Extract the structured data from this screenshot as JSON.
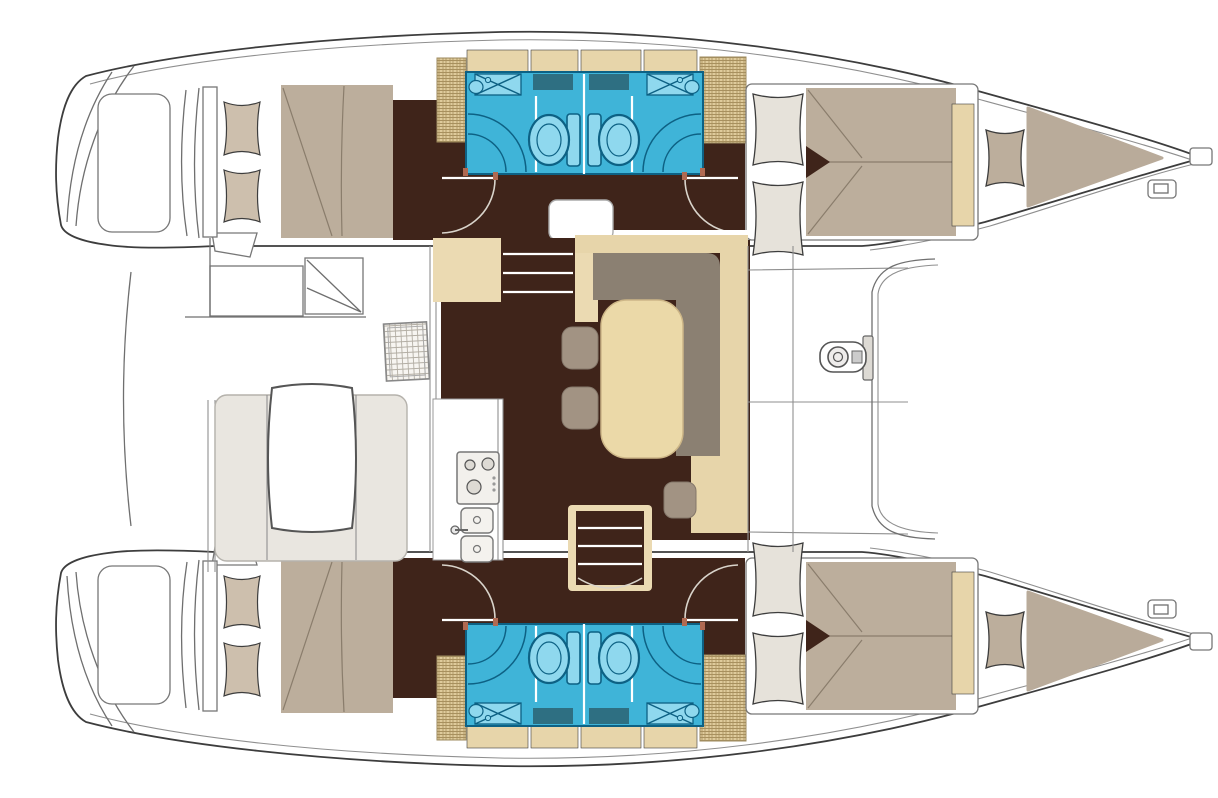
{
  "meta": {
    "diagram_type": "catamaran-yacht-floor-plan",
    "view": "top-down",
    "orientation": "bow-right",
    "hull_count": 2,
    "cabin_count": 4,
    "head_count": 4
  },
  "palette": {
    "background": "#ffffff",
    "outline": "#3d3d3d",
    "floor_dark": "#3f241a",
    "bathroom": "#3fb4d8",
    "bathroom_light": "#8fd8ee",
    "bathroom_line": "#0d6184",
    "bathroom_inset": "#2e6f82",
    "mattress": "#bcae9c",
    "sunpad": "#b9ab9a",
    "pillow_aft": "#cdbfad",
    "pillow_fwd": "#e6e2da",
    "cabinet_tan": "#e7d5aa",
    "locker_tan": "#dfcb9c",
    "steps_tan": "#ebdab2",
    "sofa_gray": "#8b8072",
    "table_tan": "#ebd9a8",
    "stool_gray": "#a29383",
    "bench_gray": "#e9e6e0",
    "white": "#ffffff",
    "post_red": "#b06a52",
    "stove_face": "#f2f0ec"
  },
  "regions": {
    "hulls": [
      "port-hull",
      "starboard-hull"
    ],
    "rooms": [
      "aft-cabin-port",
      "head-aft-port",
      "head-forward-port",
      "forward-cabin-port",
      "salon",
      "galley",
      "cockpit",
      "foredeck",
      "aft-cabin-starboard",
      "head-aft-starboard",
      "head-forward-starboard",
      "forward-cabin-starboard"
    ],
    "fixtures": [
      "toilet",
      "shower",
      "sink",
      "stove",
      "double-sink",
      "dining-table",
      "cockpit-table",
      "sofa",
      "stool",
      "companionway-stairs",
      "winch",
      "cleat",
      "bow-roller",
      "bow-sunpad",
      "pillow",
      "swim-platform",
      "davit",
      "helm-seat",
      "deck-hatch"
    ]
  }
}
